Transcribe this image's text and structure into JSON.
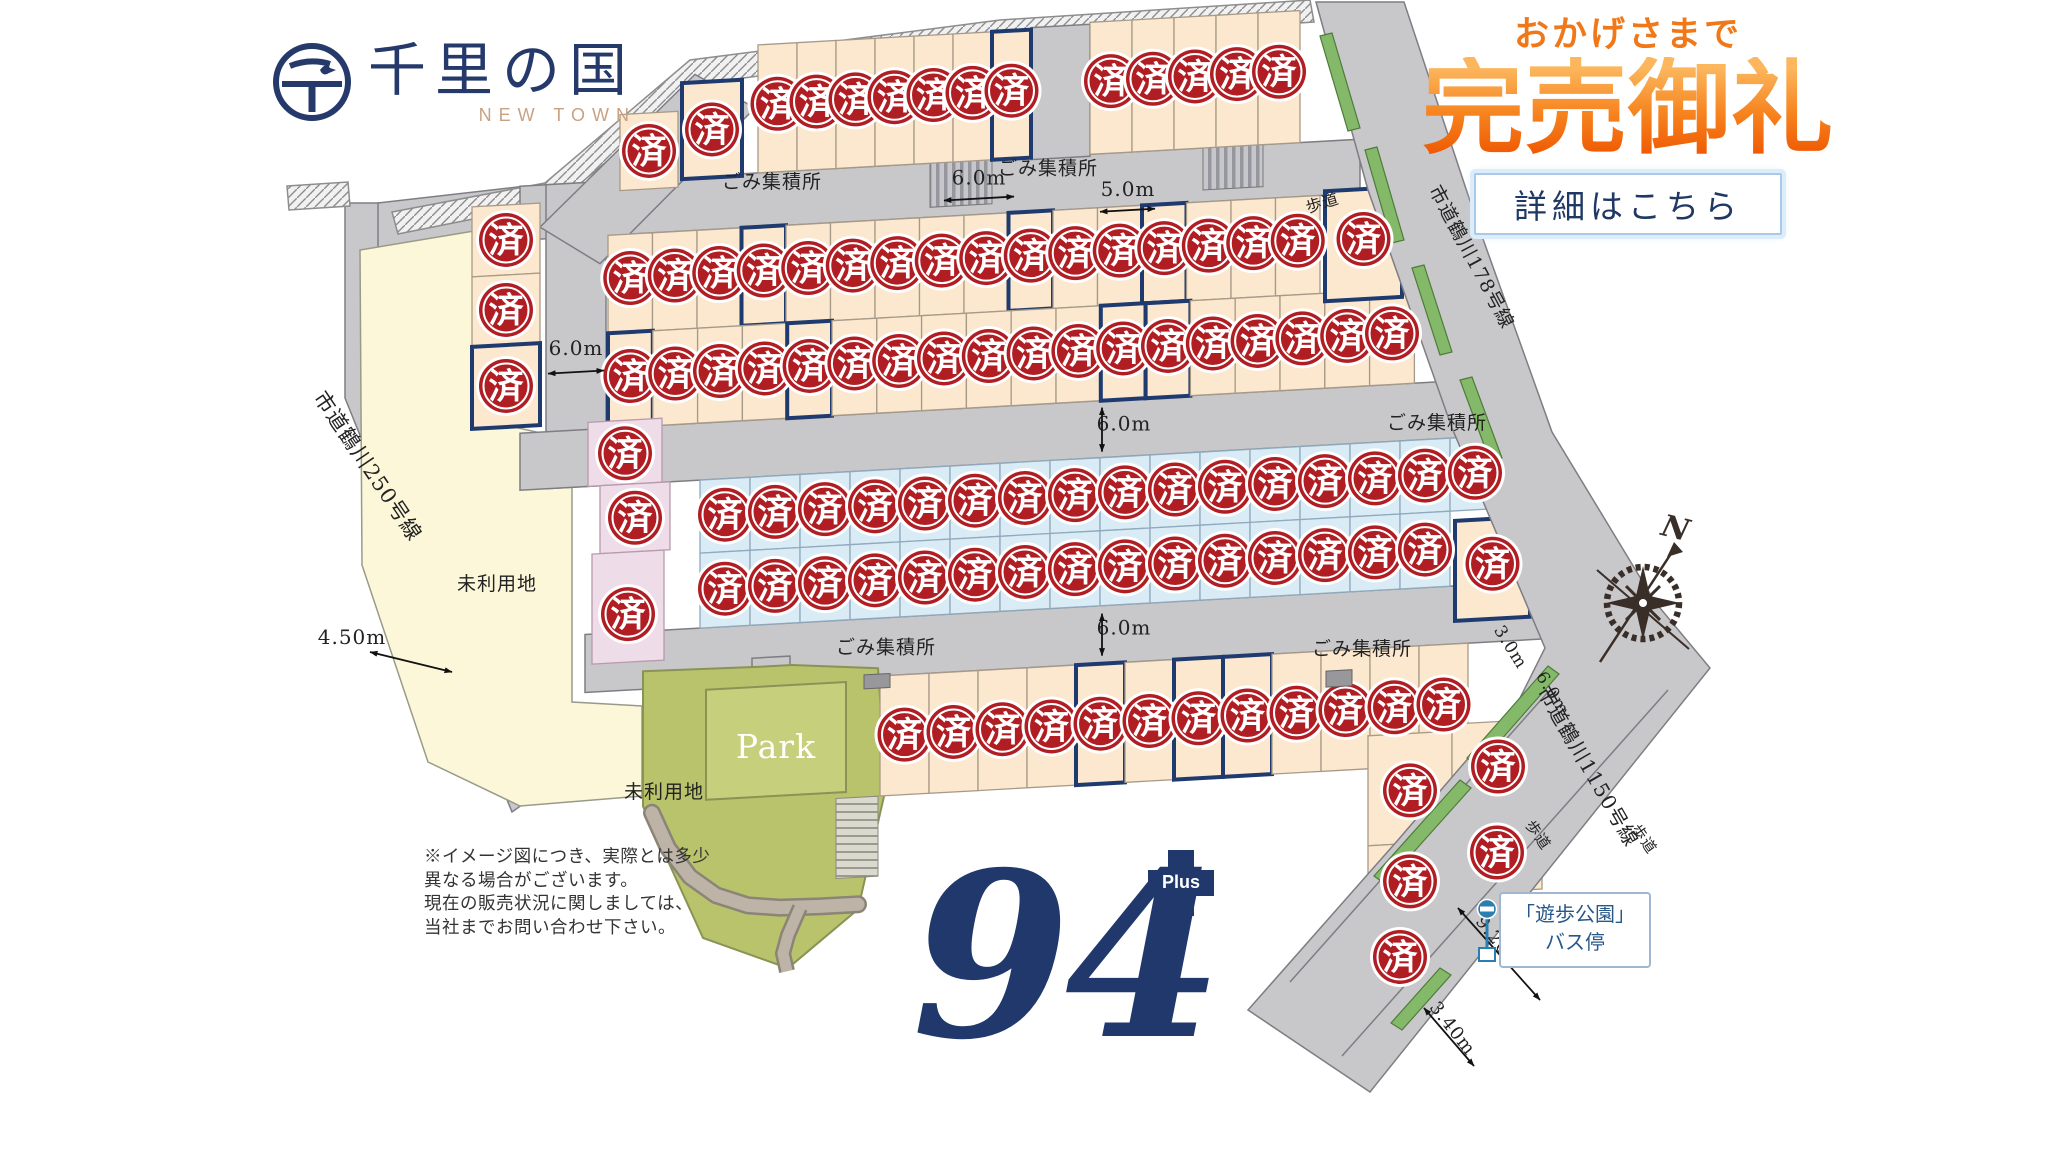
{
  "logo": {
    "title": "千里の国",
    "subtitle": "NEW TOWN",
    "emblem_char": "千"
  },
  "banner": {
    "kicker": "おかげさまで",
    "title": "完売御礼",
    "button_label": "詳細はこちら"
  },
  "big_number": {
    "value": "94",
    "plus_label": "Plus"
  },
  "disclaimer": [
    "※イメージ図につき、実際とは多少",
    "異なる場合がございます。",
    "現在の販売状況に関しましては、",
    "当社までお問い合わせ下さい。"
  ],
  "map": {
    "badge_char": "済",
    "tilt": 0.0559,
    "pivot": 1024,
    "colors": {
      "road": "#c8c8cb",
      "edge": "#7d7d83",
      "cream": "#fbe8cf",
      "cream_edge": "#a89a88",
      "blue": "#d9ecf6",
      "blue_edge": "#90a9bc",
      "pink": "#efdce9",
      "pink_edge": "#b79aab",
      "yellow": "#fbf7d8",
      "yellow_edge": "#9a9a8a",
      "olive": "#b9c36b",
      "olive_edge": "#8a9355",
      "park_inner": "#c6d07c",
      "path_dark": "#8a8577",
      "path_light": "#bdb3a6",
      "navy": "#1e3a6e",
      "badge": "#b01e23",
      "green": "#83b968",
      "green_edge": "#4e7b3a",
      "text": "#222222",
      "compass": "#3a2e28",
      "bus": "#2b7fb0",
      "bus_text": "#27588a"
    },
    "flat_areas": [
      {
        "name": "road-250",
        "pts": [
          345,
          203,
          380,
          203,
          380,
          388,
          543,
          790,
          512,
          812,
          345,
          398
        ],
        "fill": "road"
      },
      {
        "name": "road-connector",
        "pts": [
          378,
          203,
          526,
          186,
          526,
          244,
          378,
          252
        ],
        "fill": "road"
      },
      {
        "name": "unused-land",
        "pts": [
          360,
          250,
          480,
          230,
          483,
          420,
          572,
          440,
          572,
          702,
          642,
          706,
          642,
          796,
          520,
          806,
          428,
          762,
          362,
          565
        ],
        "fill": "yellow"
      },
      {
        "name": "retaining-wall",
        "pts": [
          392,
          212,
          545,
          183,
          690,
          60,
          1000,
          20,
          1310,
          0,
          1314,
          22,
          1005,
          42,
          700,
          84,
          558,
          202,
          398,
          234
        ],
        "fill": "hatch"
      },
      {
        "name": "retaining-wall-west",
        "pts": [
          287,
          186,
          348,
          182,
          350,
          206,
          289,
          210
        ],
        "fill": "hatch"
      }
    ],
    "roads": [
      {
        "x": 520,
        "y": 158,
        "w": 840,
        "h": 54
      },
      {
        "x": 546,
        "y": 158,
        "w": 60,
        "h": 304
      },
      {
        "x": 520,
        "y": 405,
        "w": 958,
        "h": 57
      },
      {
        "x": 585,
        "y": 610,
        "w": 1027,
        "h": 58
      },
      {
        "x": 1031,
        "y": 28,
        "w": 59,
        "h": 132
      },
      {
        "x": 752,
        "y": 643,
        "w": 38,
        "h": 30
      }
    ],
    "diag_road_pts": [
      540,
      200,
      695,
      56,
      755,
      93,
      600,
      240
    ],
    "crosswalks": [
      [
        930,
        152,
        62,
        50
      ],
      [
        1203,
        150,
        60,
        50
      ]
    ],
    "park": {
      "outer_pts": [
        643,
        650,
        757,
        652,
        792,
        652,
        878,
        660,
        886,
        780,
        858,
        900,
        788,
        955,
        703,
        920,
        643,
        785
      ],
      "inner": [
        706,
        672,
        140,
        110
      ],
      "stairs": [
        836,
        788,
        42,
        80
      ],
      "path_pts": [
        652,
        792,
        668,
        828,
        690,
        858,
        716,
        878,
        748,
        890,
        780,
        894,
        820,
        895,
        858,
        895
      ],
      "path2_pts": [
        800,
        895,
        788,
        922,
        783,
        940,
        787,
        958
      ],
      "label": "Park"
    },
    "rows": [
      {
        "x0": 758,
        "w": 39,
        "n": 7,
        "y1": 30,
        "y2": 158,
        "cy": 90,
        "navy": [
          6
        ],
        "fill": "cream"
      },
      {
        "x0": 1090,
        "w": 42,
        "n": 5,
        "y1": 26,
        "y2": 158,
        "cy": 86,
        "navy": [],
        "fill": "cream"
      },
      {
        "x0": 608,
        "w": 44.5,
        "n": 16,
        "y1": 212,
        "y2": 310,
        "cy": 256,
        "navy": [
          3,
          9,
          12
        ],
        "fill": "cream"
      },
      {
        "x0": 608,
        "w": 44.8,
        "n": 18,
        "y1": 310,
        "y2": 405,
        "cy": 354,
        "navy": [
          0,
          4,
          11,
          12
        ],
        "fill": "cream"
      },
      {
        "x0": 700,
        "w": 50,
        "n": 16,
        "y1": 462,
        "y2": 535,
        "cy": 498,
        "navy": [],
        "fill": "blue"
      },
      {
        "x0": 700,
        "w": 50,
        "n": 15,
        "y1": 535,
        "y2": 610,
        "cy": 572,
        "navy": [],
        "fill": "blue"
      },
      {
        "x0": 880,
        "w": 49,
        "n": 12,
        "y1": 668,
        "y2": 788,
        "cy": 728,
        "navy": [
          4,
          6,
          7
        ],
        "fill": "cream"
      }
    ],
    "extra_lots": [
      {
        "x": 620,
        "y": 92,
        "w": 58,
        "h": 76,
        "cy": 130,
        "fill": "cream"
      },
      {
        "x": 682,
        "y": 64,
        "w": 60,
        "h": 96,
        "cy": 112,
        "hl": 1,
        "fill": "cream"
      },
      {
        "x": 472,
        "y": 176,
        "w": 68,
        "h": 70,
        "cy": 211,
        "fill": "cream"
      },
      {
        "x": 472,
        "y": 246,
        "w": 68,
        "h": 70,
        "cy": 281,
        "fill": "cream"
      },
      {
        "x": 472,
        "y": 316,
        "w": 68,
        "h": 82,
        "cy": 357,
        "hl": 1,
        "fill": "cream"
      },
      {
        "x": 1325,
        "y": 208,
        "w": 77,
        "h": 110,
        "cy": 258,
        "hl": 1,
        "fill": "cream"
      },
      {
        "x": 1455,
        "y": 545,
        "w": 75,
        "h": 100,
        "cy": 590,
        "hl": 1,
        "fill": "cream"
      },
      {
        "x": 588,
        "y": 398,
        "w": 74,
        "h": 64,
        "cy": 431,
        "fill": "pink"
      },
      {
        "x": 600,
        "y": 462,
        "w": 70,
        "h": 68,
        "cy": 496,
        "fill": "pink"
      },
      {
        "x": 592,
        "y": 530,
        "w": 72,
        "h": 110,
        "cy": 592,
        "fill": "pink"
      },
      {
        "x": 1368,
        "y": 755,
        "w": 84,
        "h": 110,
        "cy": 812,
        "fill": "cream"
      },
      {
        "x": 1368,
        "y": 865,
        "w": 84,
        "h": 78,
        "cy": 903,
        "fill": "cream"
      },
      {
        "x": 1360,
        "y": 943,
        "w": 80,
        "h": 74,
        "cy": 978,
        "fill": "cream"
      },
      {
        "x": 1452,
        "y": 748,
        "w": 92,
        "h": 94,
        "cy": 793,
        "fill": "cream"
      },
      {
        "x": 1452,
        "y": 842,
        "w": 90,
        "h": 76,
        "cy": 879,
        "fill": "cream"
      }
    ],
    "labels_tilted": [
      {
        "t": "ごみ集積所",
        "x": 772,
        "y": 174,
        "s": 19
      },
      {
        "t": "ごみ集積所",
        "x": 1048,
        "y": 176,
        "s": 19
      },
      {
        "t": "ごみ集積所",
        "x": 1437,
        "y": 452,
        "s": 19
      },
      {
        "t": "ごみ集積所",
        "x": 886,
        "y": 646,
        "s": 19
      },
      {
        "t": "ごみ集積所",
        "x": 1362,
        "y": 674,
        "s": 19
      },
      {
        "t": "6.0m",
        "x": 979,
        "y": 182,
        "s": 20
      },
      {
        "t": "5.0m",
        "x": 1128,
        "y": 202,
        "s": 20
      },
      {
        "t": "6.0m",
        "x": 576,
        "y": 330,
        "s": 20
      },
      {
        "t": "6.0m",
        "x": 1124,
        "y": 436,
        "s": 20
      },
      {
        "t": "6.0m",
        "x": 1124,
        "y": 640,
        "s": 20
      },
      {
        "t": "未利用地",
        "x": 664,
        "y": 778,
        "s": 19
      },
      {
        "t": "Park",
        "x": 776,
        "y": 744,
        "s": 33,
        "fill": "#ffffff"
      }
    ],
    "arrows_tilted": [
      [
        944,
        196,
        1014,
        196
      ],
      [
        1100,
        216,
        1155,
        216
      ],
      [
        548,
        347,
        604,
        347
      ],
      [
        1102,
        412,
        1102,
        456
      ],
      [
        1102,
        618,
        1102,
        660
      ]
    ],
    "boxes_tilted": [
      [
        864,
        666,
        26,
        14
      ],
      [
        1326,
        688,
        26,
        16
      ]
    ],
    "labels_flat": [
      {
        "t": "未利用地",
        "x": 497,
        "y": 590,
        "s": 19
      },
      {
        "t": "4.50m",
        "x": 352,
        "y": 644,
        "s": 20
      },
      {
        "t": "市道鶴川250号線",
        "x": 362,
        "y": 470,
        "r": 56,
        "s": 21
      },
      {
        "t": "市道鶴川178号線",
        "x": 1466,
        "y": 260,
        "r": 62,
        "s": 19
      },
      {
        "t": "市道鶴川1150号線",
        "x": 1582,
        "y": 770,
        "r": 60,
        "s": 20
      },
      {
        "t": "歩道",
        "x": 1324,
        "y": 208,
        "r": -17,
        "s": 16
      },
      {
        "t": "歩道",
        "x": 1534,
        "y": 838,
        "r": 55,
        "s": 15
      },
      {
        "t": "歩道",
        "x": 1640,
        "y": 842,
        "r": 55,
        "s": 15
      },
      {
        "t": "3.0m",
        "x": 1506,
        "y": 650,
        "r": 58,
        "s": 17
      },
      {
        "t": "6.0m",
        "x": 1548,
        "y": 696,
        "r": 58,
        "s": 17
      },
      {
        "t": "9.20m",
        "x": 1494,
        "y": 946,
        "r": 52,
        "s": 18
      },
      {
        "t": "3.40m",
        "x": 1448,
        "y": 1032,
        "r": 52,
        "s": 18
      }
    ],
    "arrows_flat": [
      [
        370,
        652,
        452,
        672
      ],
      [
        1458,
        908,
        1540,
        1000
      ],
      [
        1424,
        1008,
        1474,
        1066
      ]
    ],
    "right_road_path": "M1316,2 L1404,2 L1478,225 L1552,432 L1655,602 L1710,668 L1370,1092 L1248,1010 L1398,840 L1520,698 L1545,648 L1452,428 L1368,190 Z",
    "sidewalk_lines": [
      [
        1548,
        692,
        1290,
        982
      ],
      [
        1668,
        690,
        1342,
        1056
      ]
    ],
    "green_strips": [
      [
        1320,
        36,
        1332,
        33,
        1360,
        128,
        1348,
        131
      ],
      [
        1365,
        150,
        1377,
        147,
        1404,
        240,
        1392,
        243
      ],
      [
        1412,
        268,
        1424,
        265,
        1452,
        352,
        1440,
        355
      ],
      [
        1460,
        380,
        1472,
        377,
        1502,
        458,
        1490,
        461
      ],
      [
        1548,
        666,
        1559,
        674,
        1478,
        766,
        1467,
        758
      ],
      [
        1460,
        780,
        1471,
        788,
        1385,
        884,
        1374,
        876
      ],
      [
        1440,
        968,
        1451,
        975,
        1402,
        1030,
        1391,
        1023
      ]
    ],
    "compass": {
      "cx": 1643,
      "cy": 603,
      "r": 36,
      "n_label": "N"
    },
    "bus_stop": {
      "line1": "「遊歩公園」",
      "line2": "バス停"
    }
  }
}
